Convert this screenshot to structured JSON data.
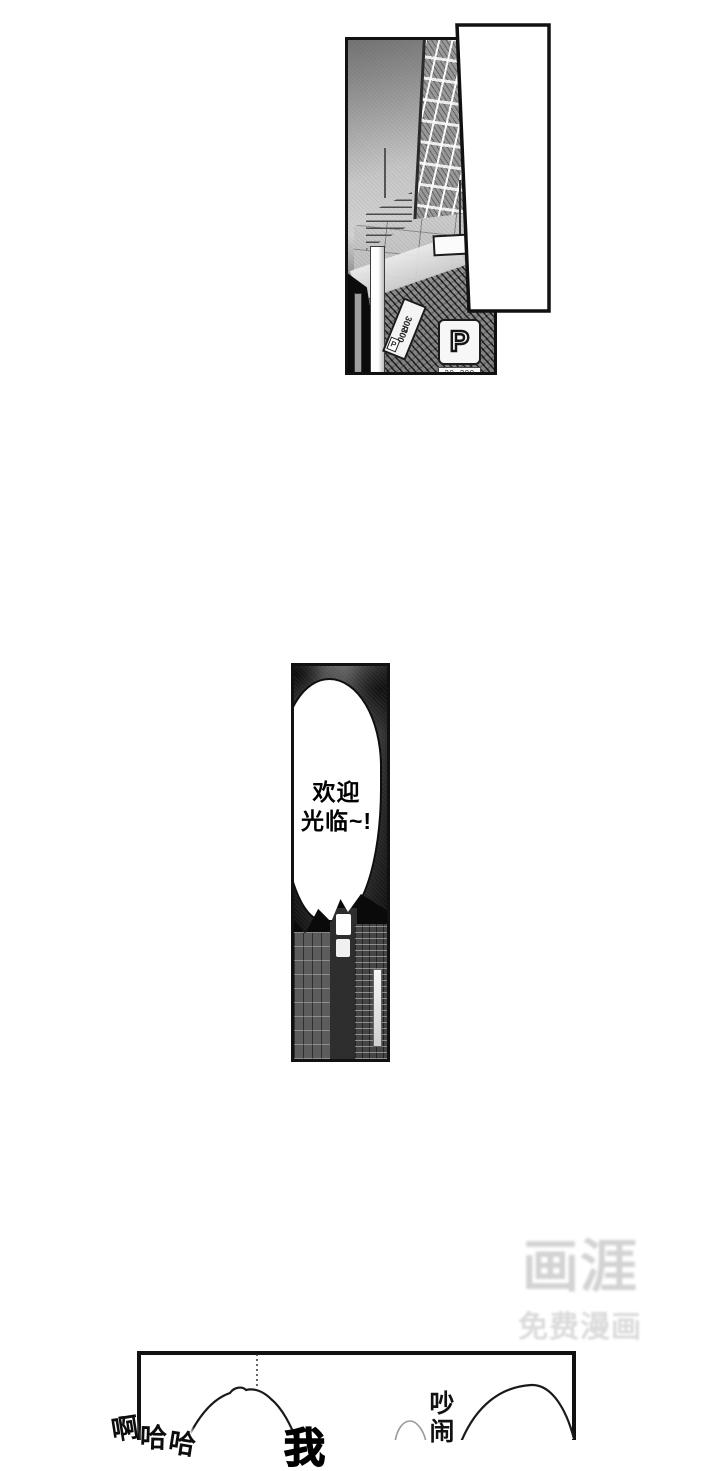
{
  "watermark": {
    "logo": "画涯",
    "subtitle": "免费漫画"
  },
  "street_panel": {
    "parking_sign": {
      "letter": "P",
      "caption": "30..300"
    },
    "pole_sign": {
      "p_mark": "P",
      "line1": "30P",
      "line2": "300"
    }
  },
  "welcome_panel": {
    "bubble": {
      "line1": "欢迎",
      "line2": "光临~!"
    }
  },
  "crowd_panel": {
    "laugh_chars": [
      "啊",
      "哈",
      "哈"
    ],
    "shout_chars": [
      "吵",
      "闹"
    ],
    "partial_char": "我"
  },
  "colors": {
    "ink": "#111111",
    "paper": "#ffffff",
    "watermark_gray": "#d3d3d3",
    "watermark_sub_gray": "#dbdbdb"
  }
}
